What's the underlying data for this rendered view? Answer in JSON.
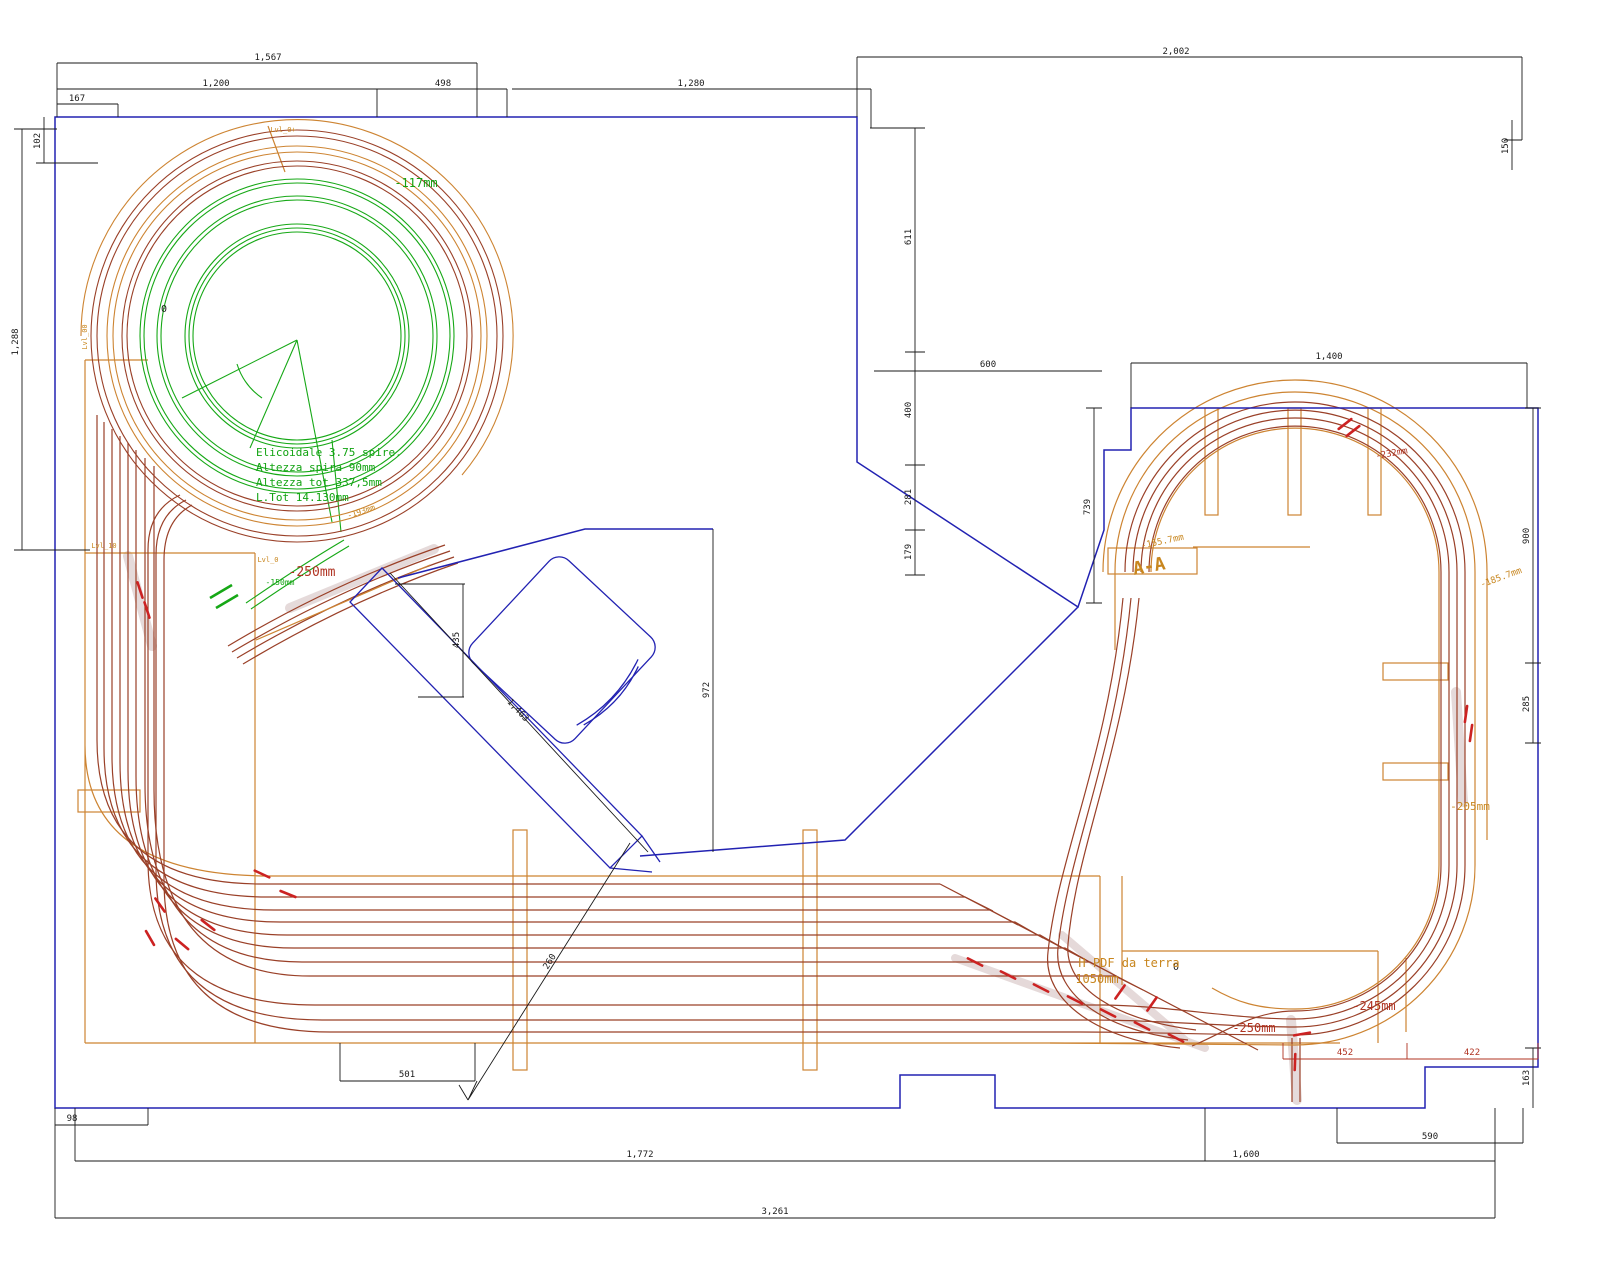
{
  "colors": {
    "k": "#1a1a1a",
    "g": "#12a312",
    "r": "#b03322",
    "o": "#c8861e",
    "navy": "#2222b2",
    "track_darkred": "#9a4028",
    "track_orange": "#cd8432",
    "track_green": "#16a816",
    "switch_red": "#cc2222",
    "highlight": "#e4d8d8"
  },
  "labels": [
    {
      "t": "1,567",
      "x": 268,
      "y": 60,
      "c": "k",
      "s": 9,
      "n": "dim-label"
    },
    {
      "t": "1,200",
      "x": 216,
      "y": 86,
      "c": "k",
      "s": 9,
      "n": "dim-label"
    },
    {
      "t": "498",
      "x": 443,
      "y": 86,
      "c": "k",
      "s": 9,
      "n": "dim-label"
    },
    {
      "t": "1,280",
      "x": 691,
      "y": 86,
      "c": "k",
      "s": 9,
      "n": "dim-label"
    },
    {
      "t": "167",
      "x": 77,
      "y": 101,
      "c": "k",
      "s": 9,
      "n": "dim-label"
    },
    {
      "t": "2,002",
      "x": 1176,
      "y": 54,
      "c": "k",
      "s": 9,
      "n": "dim-label"
    },
    {
      "t": "150",
      "x": 1508,
      "y": 146,
      "c": "k",
      "s": 9,
      "r": -90,
      "n": "dim-label"
    },
    {
      "t": "611",
      "x": 911,
      "y": 237,
      "c": "k",
      "s": 9,
      "r": -90,
      "n": "dim-label"
    },
    {
      "t": "400",
      "x": 911,
      "y": 410,
      "c": "k",
      "s": 9,
      "r": -90,
      "n": "dim-label"
    },
    {
      "t": "281",
      "x": 911,
      "y": 497,
      "c": "k",
      "s": 9,
      "r": -90,
      "n": "dim-label"
    },
    {
      "t": "179",
      "x": 911,
      "y": 552,
      "c": "k",
      "s": 9,
      "r": -90,
      "n": "dim-label"
    },
    {
      "t": "600",
      "x": 988,
      "y": 367,
      "c": "k",
      "s": 9,
      "n": "dim-label"
    },
    {
      "t": "739",
      "x": 1090,
      "y": 507,
      "c": "k",
      "s": 9,
      "r": -90,
      "n": "dim-label"
    },
    {
      "t": "1,400",
      "x": 1329,
      "y": 359,
      "c": "k",
      "s": 9,
      "n": "dim-label"
    },
    {
      "t": "900",
      "x": 1529,
      "y": 536,
      "c": "k",
      "s": 9,
      "r": -90,
      "n": "dim-label"
    },
    {
      "t": "285",
      "x": 1529,
      "y": 704,
      "c": "k",
      "s": 9,
      "r": -90,
      "n": "dim-label"
    },
    {
      "t": "163",
      "x": 1529,
      "y": 1078,
      "c": "k",
      "s": 9,
      "r": -90,
      "n": "dim-label"
    },
    {
      "t": "590",
      "x": 1430,
      "y": 1139,
      "c": "k",
      "s": 9,
      "n": "dim-label"
    },
    {
      "t": "1,772",
      "x": 640,
      "y": 1157,
      "c": "k",
      "s": 9,
      "n": "dim-label"
    },
    {
      "t": "1,600",
      "x": 1246,
      "y": 1157,
      "c": "k",
      "s": 9,
      "n": "dim-label"
    },
    {
      "t": "3,261",
      "x": 775,
      "y": 1214,
      "c": "k",
      "s": 9,
      "n": "dim-label"
    },
    {
      "t": "98",
      "x": 72,
      "y": 1121,
      "c": "k",
      "s": 9,
      "n": "dim-label"
    },
    {
      "t": "501",
      "x": 407,
      "y": 1077,
      "c": "k",
      "s": 9,
      "n": "dim-label"
    },
    {
      "t": "435",
      "x": 459,
      "y": 640,
      "c": "k",
      "s": 9,
      "r": -90,
      "n": "dim-label"
    },
    {
      "t": "1,463",
      "x": 516,
      "y": 712,
      "c": "k",
      "s": 9,
      "r": 47,
      "n": "dim-label"
    },
    {
      "t": "260",
      "x": 552,
      "y": 963,
      "c": "k",
      "s": 9,
      "r": -58,
      "n": "dim-label"
    },
    {
      "t": "972",
      "x": 709,
      "y": 690,
      "c": "k",
      "s": 9,
      "r": -90,
      "n": "dim-label"
    },
    {
      "t": "1,288",
      "x": 18,
      "y": 342,
      "c": "k",
      "s": 9,
      "r": -90,
      "n": "dim-label"
    },
    {
      "t": "102",
      "x": 40,
      "y": 141,
      "c": "k",
      "s": 9,
      "r": -90,
      "n": "dim-label"
    },
    {
      "t": "0",
      "x": 164,
      "y": 312,
      "c": "k",
      "s": 10,
      "n": "origin-marker"
    },
    {
      "t": "0",
      "x": 1176,
      "y": 970,
      "c": "k",
      "s": 10,
      "n": "origin-marker"
    },
    {
      "t": "Elicoidale 3.75 spire.",
      "x": 256,
      "y": 456,
      "c": "g",
      "s": 11,
      "a": "start",
      "n": "helix-note-line"
    },
    {
      "t": "Altezza spira 90mm",
      "x": 256,
      "y": 471,
      "c": "g",
      "s": 11,
      "a": "start",
      "n": "helix-note-line"
    },
    {
      "t": "Altezza tot 337,5mm",
      "x": 256,
      "y": 486,
      "c": "g",
      "s": 11,
      "a": "start",
      "n": "helix-note-line"
    },
    {
      "t": "L.Tot 14.130mm",
      "x": 256,
      "y": 501,
      "c": "g",
      "s": 11,
      "a": "start",
      "n": "helix-note-line"
    },
    {
      "t": "-117mm",
      "x": 416,
      "y": 187,
      "c": "g",
      "s": 12,
      "n": "elevation-label"
    },
    {
      "t": "-150mm",
      "x": 280,
      "y": 585,
      "c": "g",
      "s": 8,
      "n": "elevation-label"
    },
    {
      "t": "-250mm",
      "x": 312,
      "y": 576,
      "c": "r",
      "s": 13,
      "n": "elevation-label"
    },
    {
      "t": "-193mm",
      "x": 362,
      "y": 514,
      "c": "o",
      "s": 8,
      "r": -18,
      "n": "elevation-label"
    },
    {
      "t": "Lvl_0+",
      "x": 283,
      "y": 132,
      "c": "o",
      "s": 7,
      "n": "level-tag"
    },
    {
      "t": "Lvl_00",
      "x": 87,
      "y": 337,
      "c": "o",
      "s": 7,
      "r": -90,
      "n": "level-tag"
    },
    {
      "t": "Lvl_10",
      "x": 104,
      "y": 548,
      "c": "o",
      "s": 7,
      "n": "level-tag"
    },
    {
      "t": "Lvl_0",
      "x": 268,
      "y": 562,
      "c": "o",
      "s": 7,
      "n": "level-tag"
    },
    {
      "t": "-155.7mm",
      "x": 1163,
      "y": 544,
      "c": "o",
      "s": 9,
      "r": -12,
      "n": "elevation-label"
    },
    {
      "t": "A-A",
      "x": 1150,
      "y": 572,
      "c": "o",
      "s": 18,
      "r": -10,
      "b": 1,
      "n": "section-label"
    },
    {
      "t": "-232mm",
      "x": 1392,
      "y": 456,
      "c": "r",
      "s": 9,
      "r": -10,
      "n": "elevation-label"
    },
    {
      "t": "-185.7mm",
      "x": 1502,
      "y": 580,
      "c": "o",
      "s": 9,
      "r": -20,
      "n": "elevation-label"
    },
    {
      "t": "-205mm",
      "x": 1470,
      "y": 810,
      "c": "o",
      "s": 11,
      "n": "elevation-label"
    },
    {
      "t": "-245mm",
      "x": 1374,
      "y": 1010,
      "c": "r",
      "s": 12,
      "n": "elevation-label"
    },
    {
      "t": "-250mm",
      "x": 1254,
      "y": 1032,
      "c": "r",
      "s": 12,
      "n": "elevation-label"
    },
    {
      "t": "H PDF da terra",
      "x": 1129,
      "y": 967,
      "c": "o",
      "s": 12,
      "n": "height-note"
    },
    {
      "t": "1050mm",
      "x": 1097,
      "y": 983,
      "c": "o",
      "s": 12,
      "n": "height-note"
    },
    {
      "t": "452",
      "x": 1345,
      "y": 1055,
      "c": "r",
      "s": 9,
      "n": "dim-label"
    },
    {
      "t": "422",
      "x": 1472,
      "y": 1055,
      "c": "r",
      "s": 9,
      "n": "dim-label"
    }
  ]
}
